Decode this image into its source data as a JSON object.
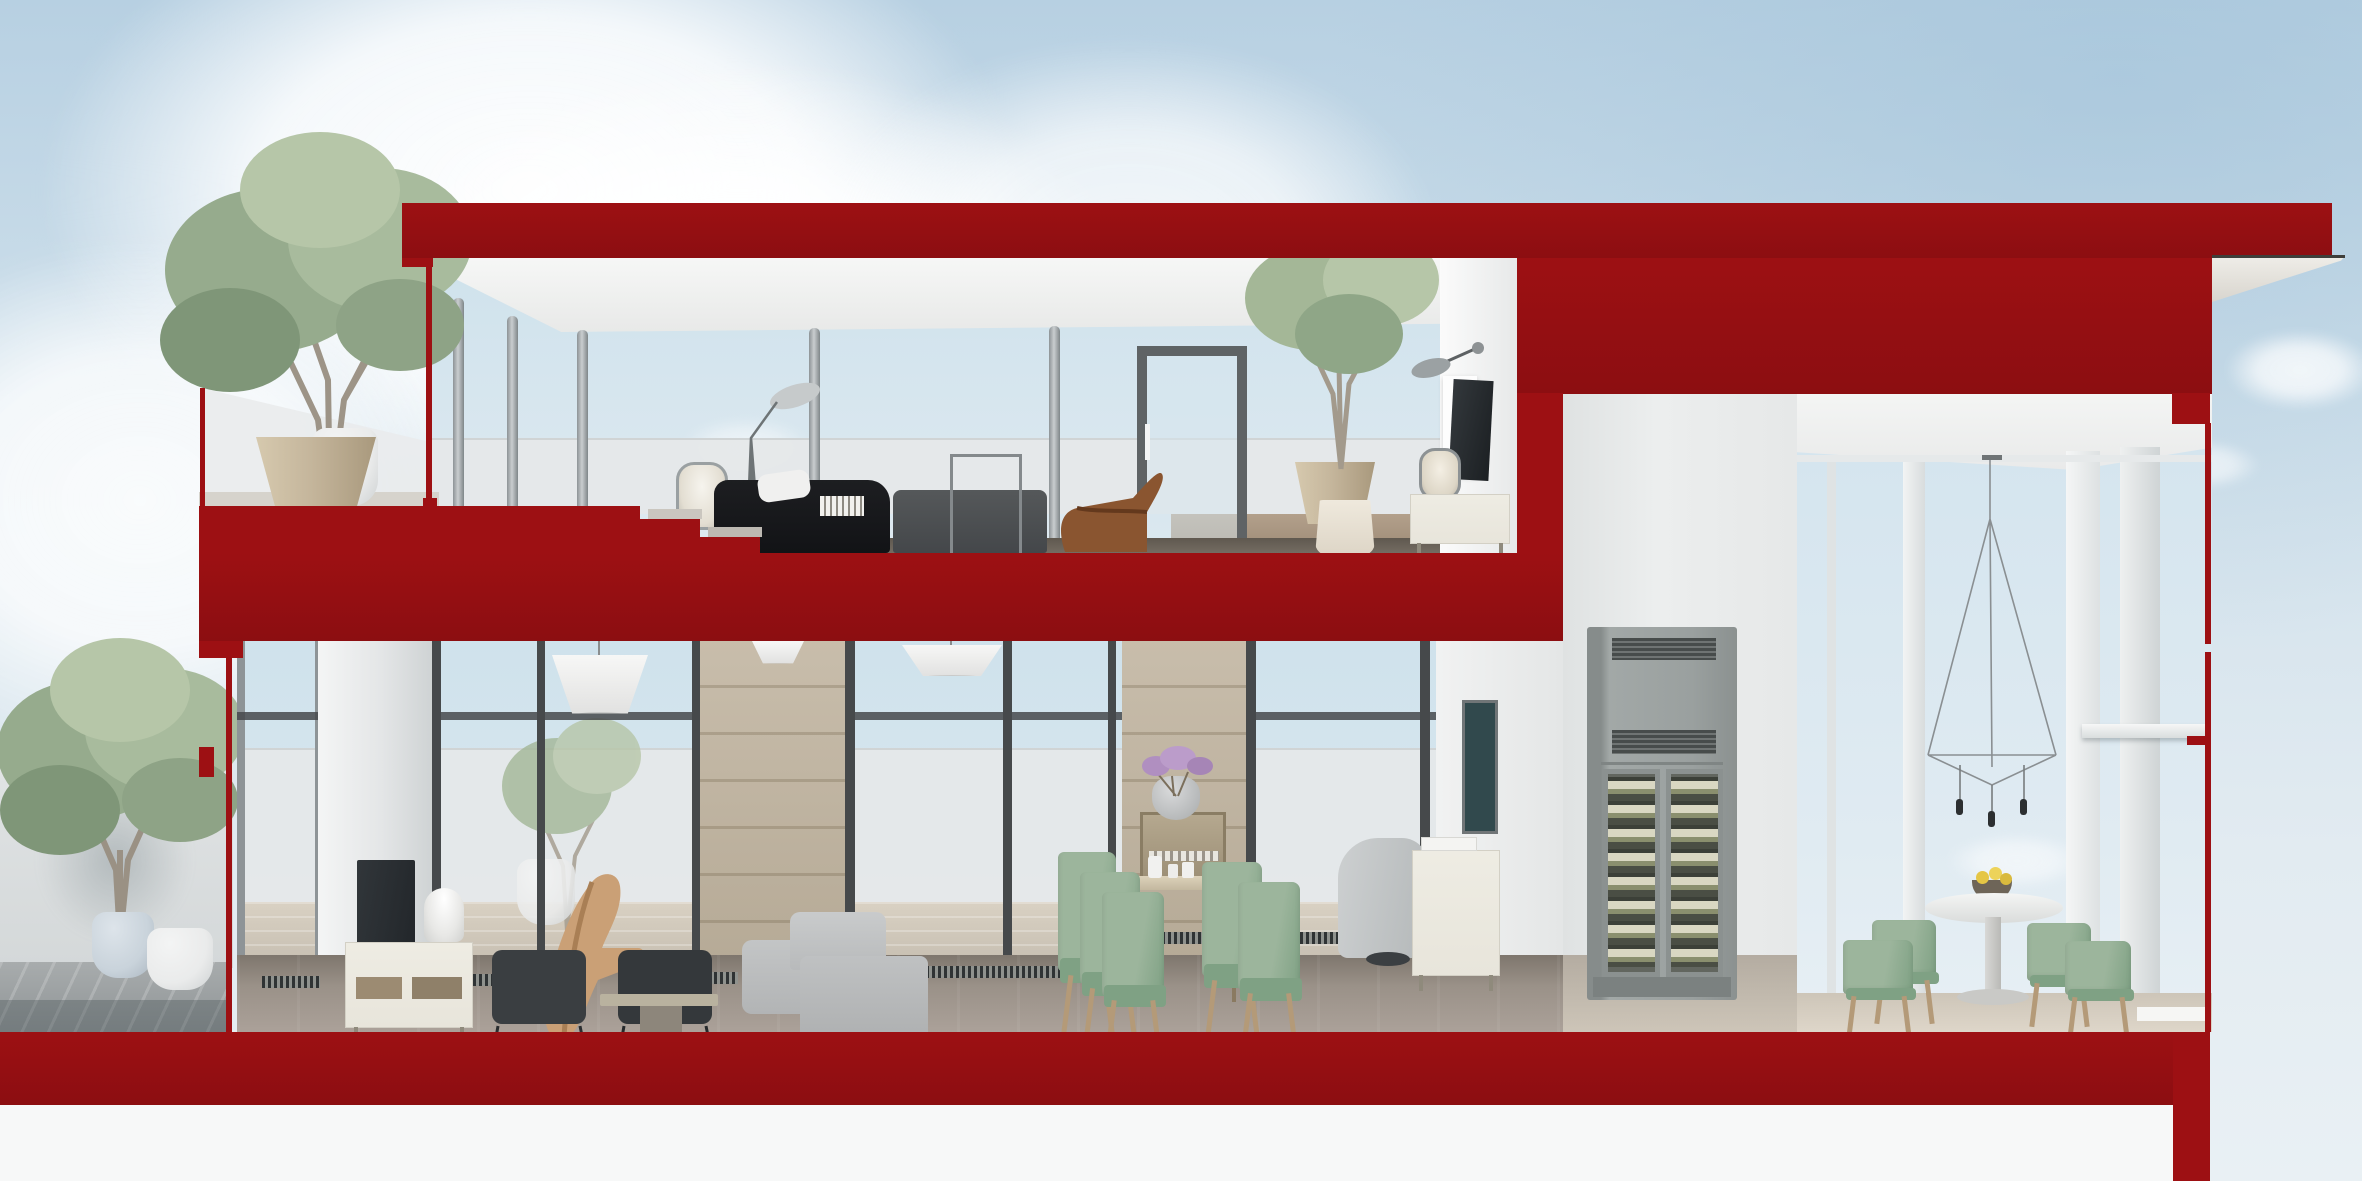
{
  "scene": {
    "kind": "architectural cross-section render",
    "description": "Two-storey penthouse apartment sectional perspective; cut walls and slabs shown in solid red; sky background with clouds; white margin below",
    "floors": [
      "upper living floor with roof terrace",
      "double-height lower living floor",
      "corner glass dining room"
    ]
  },
  "palette": {
    "red": "#9d1013",
    "red_deep": "#8c0e11",
    "sky_top": "#b7d0e2",
    "sky_mid": "#cfe0eb",
    "sky_low": "#e2ebf1",
    "page_white": "#f7f8f8",
    "glass_top": "#cfe2ec",
    "glass_low": "#dfeaf1",
    "ceiling_white": "#f3f4f3",
    "wall_white": "#eaeceb",
    "wood_wall": "#c8bdab",
    "wood_wall_dark": "#b2a692",
    "floor_wood": "#968d84",
    "deck_gray": "#9fa4a6",
    "rug": "#c6c6c2",
    "sofa_black": "#17181b",
    "sofa_charcoal": "#4b4e50",
    "sofa_light": "#b8babb",
    "cream": "#e8e5db",
    "leather_tan": "#8a5530",
    "sage": "#9cb59c",
    "sage_dark": "#7fa184",
    "chair_wood": "#b49a78",
    "clay_pot": "#c5b69c",
    "white_pot": "#eaebeb",
    "blue_pot": "#c9d3db",
    "foliage": "#9ab08f",
    "foliage_light": "#b6c6a8",
    "foliage_dark": "#7f9678",
    "trunk": "#a39a8c",
    "cabinet_gray": "#9ba1a0",
    "cabinet_vent": "#474c4b",
    "tv_dark": "#22262a",
    "frame_dark": "#46494b",
    "frame_gray": "#8e9497",
    "metal": "#b6bcbe",
    "art_teal": "#31494d",
    "flower_purple": "#b08fc0",
    "fruit_yellow": "#e5c645"
  },
  "objects": {
    "upper_floor": [
      "roof-slab-cut",
      "terrace-glass-balustrade",
      "potted-tree",
      "clay-planter",
      "floor-lamp",
      "portable-lantern-lamp",
      "black-lounge-sofa",
      "charcoal-sofa",
      "book-stack",
      "leather-lounge-chair",
      "glass-door",
      "stone-planter-tree",
      "wall-sconce",
      "wall-tv",
      "lantern-lamp",
      "cream-sideboard",
      "tote-bag"
    ],
    "lower_floor": [
      "terrace-parapet",
      "deck",
      "potted-trees",
      "sliding-glass-doors",
      "wall-tv",
      "tv-sideboard",
      "table-lamp",
      "wire-frame-chairs",
      "plywood-lounge-chair",
      "coffee-table",
      "rug",
      "modular-sofa",
      "pendant-lamps",
      "wood-panel-wall",
      "dining-table",
      "sage-dining-chairs",
      "console-shelf",
      "stacked-vases",
      "purple-flowers",
      "artwork",
      "swivel-lounge-chair",
      "sideboard",
      "wine-climate-cabinet"
    ],
    "right_room": [
      "corner-glazing",
      "wireframe-pendant-light",
      "round-pedestal-table",
      "fruit-bowl",
      "sage-armchairs",
      "handrail"
    ],
    "section_cuts": [
      "roof-slab",
      "intermediate-slab",
      "ground-slab",
      "right-wall-mass",
      "partition-wall",
      "glazing-cut-lines"
    ]
  }
}
